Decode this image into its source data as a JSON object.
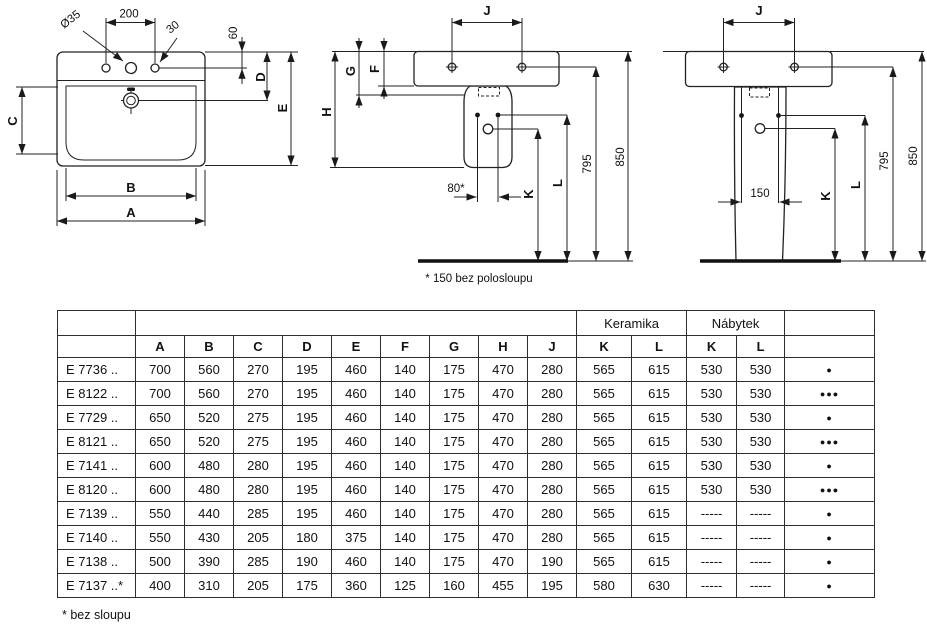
{
  "drawings": {
    "top_view": {
      "dia": "Ø35",
      "d200": "200",
      "d30": "30",
      "d60": "60",
      "A": "A",
      "B": "B",
      "C": "C",
      "D": "D",
      "E": "E"
    },
    "side_view": {
      "J": "J",
      "G": "G",
      "F": "F",
      "H": "H",
      "d80": "80*",
      "K": "K",
      "L": "L",
      "d795": "795",
      "d850": "850",
      "note": "* 150 bez polosloupu"
    },
    "front_view": {
      "J": "J",
      "d150": "150",
      "K": "K",
      "L": "L",
      "d795": "795",
      "d850": "850"
    }
  },
  "table": {
    "group_headers": [
      {
        "label": "Keramika",
        "span": 2
      },
      {
        "label": "Nábytek",
        "span": 2
      }
    ],
    "columns": [
      "A",
      "B",
      "C",
      "D",
      "E",
      "F",
      "G",
      "H",
      "J",
      "K",
      "L",
      "K",
      "L"
    ],
    "rows": [
      {
        "model": "E 7736 ..",
        "values": [
          "700",
          "560",
          "270",
          "195",
          "460",
          "140",
          "175",
          "470",
          "280",
          "565",
          "615",
          "530",
          "530"
        ],
        "marker": "●"
      },
      {
        "model": "E 8122 ..",
        "values": [
          "700",
          "560",
          "270",
          "195",
          "460",
          "140",
          "175",
          "470",
          "280",
          "565",
          "615",
          "530",
          "530"
        ],
        "marker": "●●●"
      },
      {
        "model": "E 7729 ..",
        "values": [
          "650",
          "520",
          "275",
          "195",
          "460",
          "140",
          "175",
          "470",
          "280",
          "565",
          "615",
          "530",
          "530"
        ],
        "marker": "●"
      },
      {
        "model": "E 8121 ..",
        "values": [
          "650",
          "520",
          "275",
          "195",
          "460",
          "140",
          "175",
          "470",
          "280",
          "565",
          "615",
          "530",
          "530"
        ],
        "marker": "●●●"
      },
      {
        "model": "E 7141 ..",
        "values": [
          "600",
          "480",
          "280",
          "195",
          "460",
          "140",
          "175",
          "470",
          "280",
          "565",
          "615",
          "530",
          "530"
        ],
        "marker": "●"
      },
      {
        "model": "E 8120 ..",
        "values": [
          "600",
          "480",
          "280",
          "195",
          "460",
          "140",
          "175",
          "470",
          "280",
          "565",
          "615",
          "530",
          "530"
        ],
        "marker": "●●●"
      },
      {
        "model": "E 7139 ..",
        "values": [
          "550",
          "440",
          "285",
          "195",
          "460",
          "140",
          "175",
          "470",
          "280",
          "565",
          "615",
          "-----",
          "-----"
        ],
        "marker": "●"
      },
      {
        "model": "E 7140 ..",
        "values": [
          "550",
          "430",
          "205",
          "180",
          "375",
          "140",
          "175",
          "470",
          "280",
          "565",
          "615",
          "-----",
          "-----"
        ],
        "marker": "●"
      },
      {
        "model": "E 7138 ..",
        "values": [
          "500",
          "390",
          "285",
          "190",
          "460",
          "140",
          "175",
          "470",
          "190",
          "565",
          "615",
          "-----",
          "-----"
        ],
        "marker": "●"
      },
      {
        "model": "E 7137 ..*",
        "values": [
          "400",
          "310",
          "205",
          "175",
          "360",
          "125",
          "160",
          "455",
          "195",
          "580",
          "630",
          "-----",
          "-----"
        ],
        "marker": "●"
      }
    ]
  },
  "footnote": "* bez sloupu"
}
